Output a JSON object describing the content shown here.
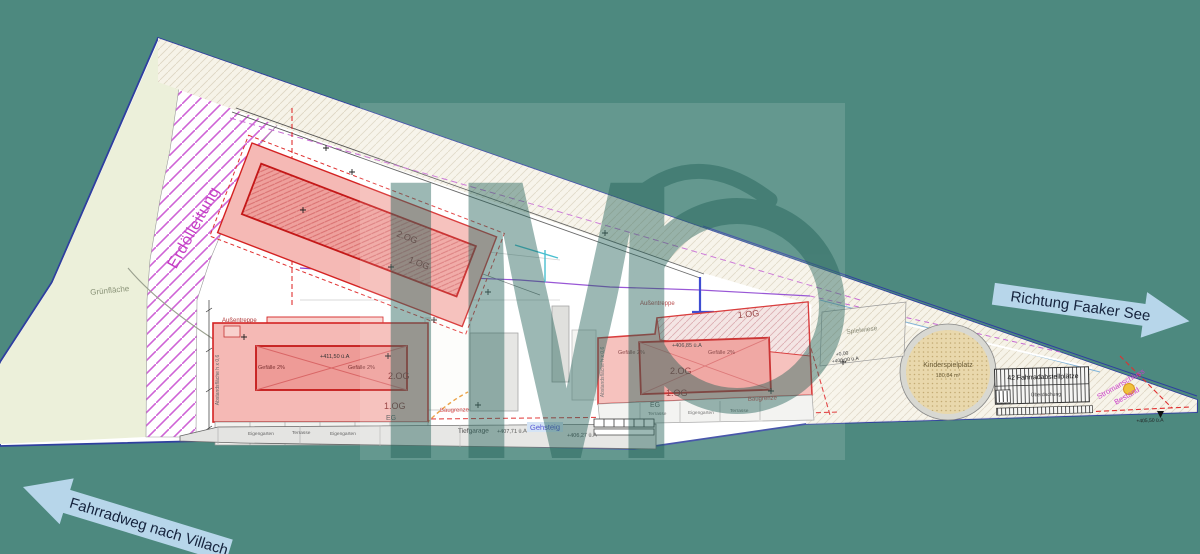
{
  "colors": {
    "background": "#4d897f",
    "plan_paper": "#ffffff",
    "building_fill": "#f5b9b5",
    "building_roof": "#ee9b97",
    "building_border": "#d42222",
    "pipeline_magenta": "#c43cc4",
    "arrow_fill": "#b7d6ea",
    "arrow_text": "#15233d",
    "boundary_blue": "#2f3f9f",
    "boundary_red_dash": "#e03030",
    "green_area_fill": "#ecf0da",
    "playground_fill": "#e9d8ac",
    "watermark": "#1f5f56",
    "power_dot_yellow": "#f0c23a"
  },
  "arrows": {
    "right": {
      "label": "Richtung Faaker See"
    },
    "left": {
      "label": "Fahrradweg nach Villach"
    }
  },
  "annotations": {
    "pipeline": "Erdölleitung",
    "green_area": "Grünfläche",
    "meadow": "Spielwiese",
    "sidewalk": "Gehsteig",
    "garage": "Tiefgarage",
    "stairs": "Außentreppe",
    "boundary": "Baugrenze",
    "slope": "Gefälle 2%",
    "setback": "Abstandsfläche h x 0,6",
    "garden": "Eigengarten",
    "terrace": "Terrasse",
    "power_line1": "Stromanschluss",
    "power_line2": "Bestand"
  },
  "playground": {
    "name": "Kinderspielplatz",
    "area": "180,84 m²"
  },
  "bike": {
    "label": "42 Fahrradabstellplätze",
    "sub": "Überdachung"
  },
  "floors": {
    "f2": "2.OG",
    "f1": "1.OG",
    "f0": "EG"
  },
  "elev": {
    "street": "+406,27 ü.A",
    "garage": "+407,71 ü.A",
    "b_center": "+411,50 ü.A",
    "c_center": "+406,85 ü.A",
    "zero": "+0,00",
    "zero_abs": "+406,00 ü.A",
    "tip": "+405,50 ü.A"
  },
  "watermark": {
    "letters": "IM"
  }
}
